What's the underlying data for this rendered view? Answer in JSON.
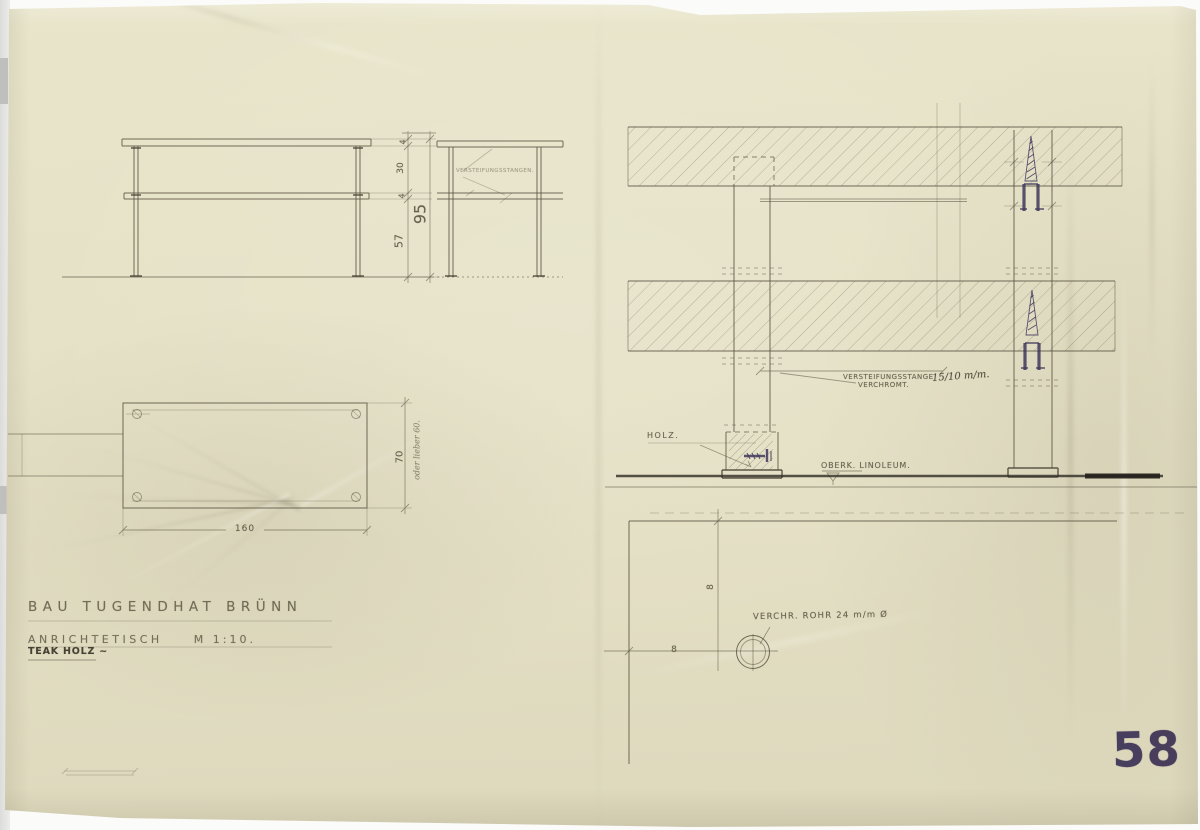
{
  "drawing": {
    "title_block": {
      "project": "BAU TUGENDHAT BRÜNN",
      "subject": "ANRICHTETISCH",
      "scale": "M 1:10.",
      "material": "TEAK HOLZ ~"
    },
    "page_stamp": "58",
    "front_elevation": {
      "dims": {
        "top_thickness": "4",
        "clear_height": "30",
        "shelf_thickness": "4",
        "leg_height": "57",
        "total_height": "95"
      }
    },
    "end_elevation": {
      "note": "VERSTEIFUNGSSTANGEN."
    },
    "plan_view": {
      "dims": {
        "length": "160",
        "depth": "70",
        "depth_note": "oder lieber 60."
      }
    },
    "section_detail": {
      "stiffener_label_line1": "VERSTEIFUNGSSTANGE",
      "stiffener_label_line2": "VERCHROMT.",
      "stiffener_size": "15/10 m/m.",
      "wood_label": "HOLZ.",
      "floor_label": "OBERK. LINOLEUM."
    },
    "plan_detail": {
      "tube_label": "VERCHR. ROHR 24 m/m Ø",
      "offset_x": "8",
      "offset_y": "8"
    },
    "colors": {
      "paper": "#e5e1c6",
      "pencil": "#5a5342",
      "ink": "#3d3356"
    }
  }
}
